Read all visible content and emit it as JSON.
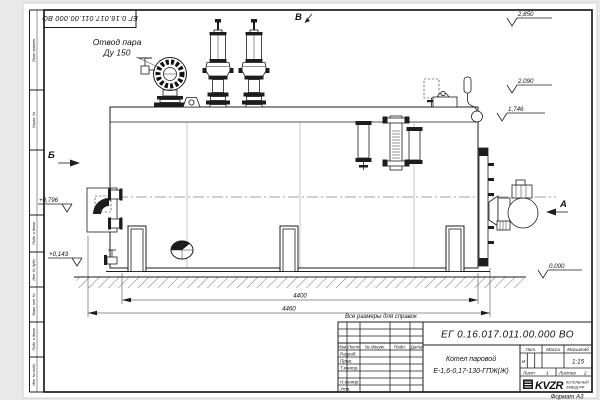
{
  "corner_stamp": "ЕГ 0.16.017.011.00.000  ВО",
  "margin_labels": [
    "Перв. примен.",
    "Справ. №",
    "Подп. и дата",
    "Инв. № дубл.",
    "Взам. инв. №",
    "Подп. и дата",
    "Инв. № подл."
  ],
  "annotations": {
    "steam_outlet_1": "Отвод пара",
    "steam_outlet_2": "Ду 150",
    "note": "Все размеры для справок",
    "view_a": "А",
    "view_b": "Б",
    "view_v": "В"
  },
  "elevations": {
    "top": "2,850",
    "mid": "2,090",
    "drum": "1,746",
    "front_upper": "+0,796",
    "front_lower": "+0,143",
    "ground": "0,000"
  },
  "dimensions": {
    "inner": "4400",
    "overall": "4460"
  },
  "title_block": {
    "doc_number": "ЕГ 0.16.017.011.00.000  ВО",
    "name_line1": "Котел паровой",
    "name_line2": "Е-1,6-0,17-130-ГПЖ(Ж)",
    "header": {
      "izm": "Изм.",
      "list": "Лист",
      "doc": "№ докум.",
      "podp": "Подп.",
      "data": "Дата"
    },
    "rows": {
      "razrab": "Разраб.",
      "prov": "Пров.",
      "tkontr": "Т.контр.",
      "nkontr": "Н.контр.",
      "utv": "Утв."
    },
    "props": {
      "lit": "Лит.",
      "mass": "Масса",
      "scale_label": "Масштаб",
      "lit_value": "И",
      "scale": "1:15"
    },
    "sheets": {
      "list_label": "Лист",
      "list_value": "1",
      "listov_label": "Листов",
      "listov_value": "2"
    },
    "logo": {
      "text": "KVZR",
      "sub1": "КОТЕЛЬНЫЙ",
      "sub2": "ЗАВОД РФ"
    },
    "format": "Формат А3"
  }
}
